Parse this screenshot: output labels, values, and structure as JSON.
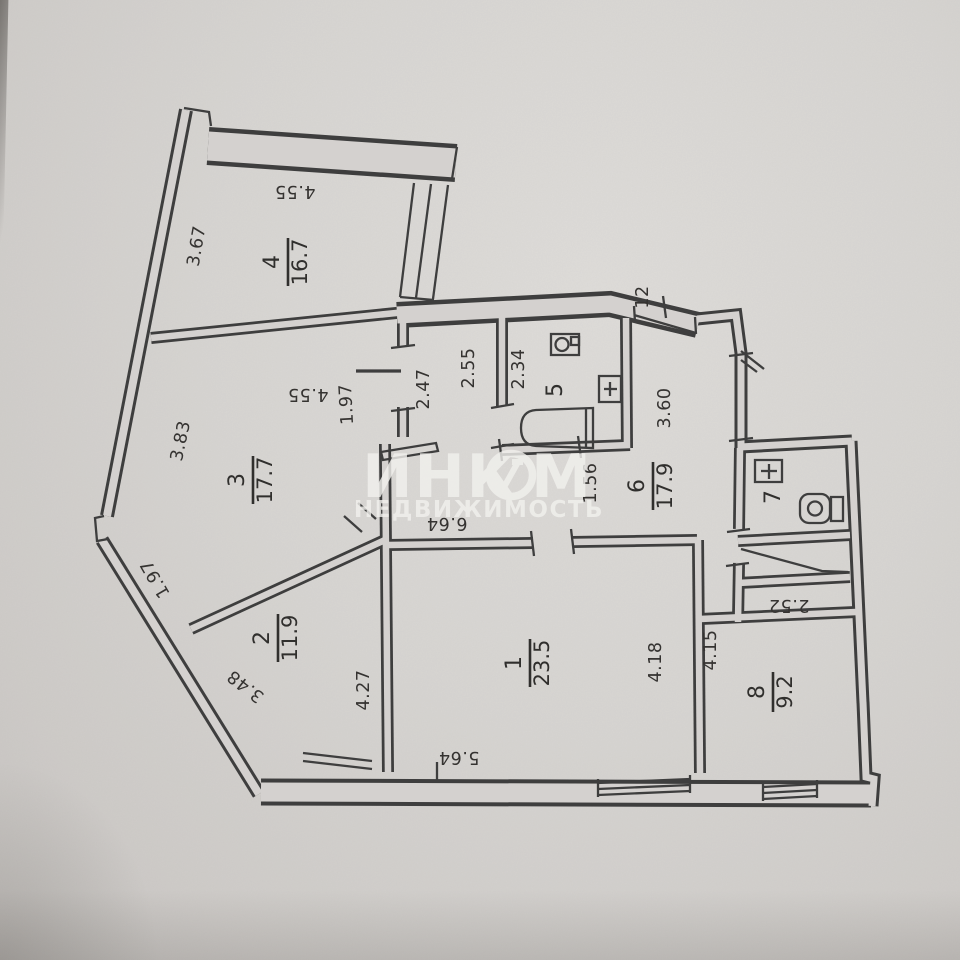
{
  "document": {
    "type": "apartment-floor-plan",
    "source_brand": "ИНКОМ НЕДВИЖИМОСТЬ"
  },
  "watermark": {
    "brand_left": "ИНК",
    "brand_right": "М",
    "brand_o_symbol": "stylized-slash-in-circle",
    "subtitle": "НЕДВИЖИМОСТЬ"
  },
  "rooms": [
    {
      "number": "1",
      "area": "23.5"
    },
    {
      "number": "2",
      "area": "11.9"
    },
    {
      "number": "3",
      "area": "17.7"
    },
    {
      "number": "4",
      "area": "16.7"
    },
    {
      "number": "5",
      "area": ""
    },
    {
      "number": "6",
      "area": "17.9"
    },
    {
      "number": "7",
      "area": ""
    },
    {
      "number": "8",
      "area": "9.2"
    }
  ],
  "dimensions": [
    "3.67",
    "4.55",
    "4.55",
    "3.83",
    "1.97",
    "2.47",
    "2.55",
    "2.34",
    "12",
    "3.60",
    "1.56",
    "6.64",
    "1.97",
    "3.48",
    "4.27",
    "5.64",
    "4.18",
    "4.15",
    "2.52"
  ],
  "fixtures": [
    "bathtub-icon",
    "sink-icon",
    "water-heater-icon",
    "toilet-icon",
    "water-heater-icon"
  ],
  "colors": {
    "paper": "#d7d4d1",
    "ink": "#3c3c3c",
    "watermark": "#f5f4f1"
  }
}
